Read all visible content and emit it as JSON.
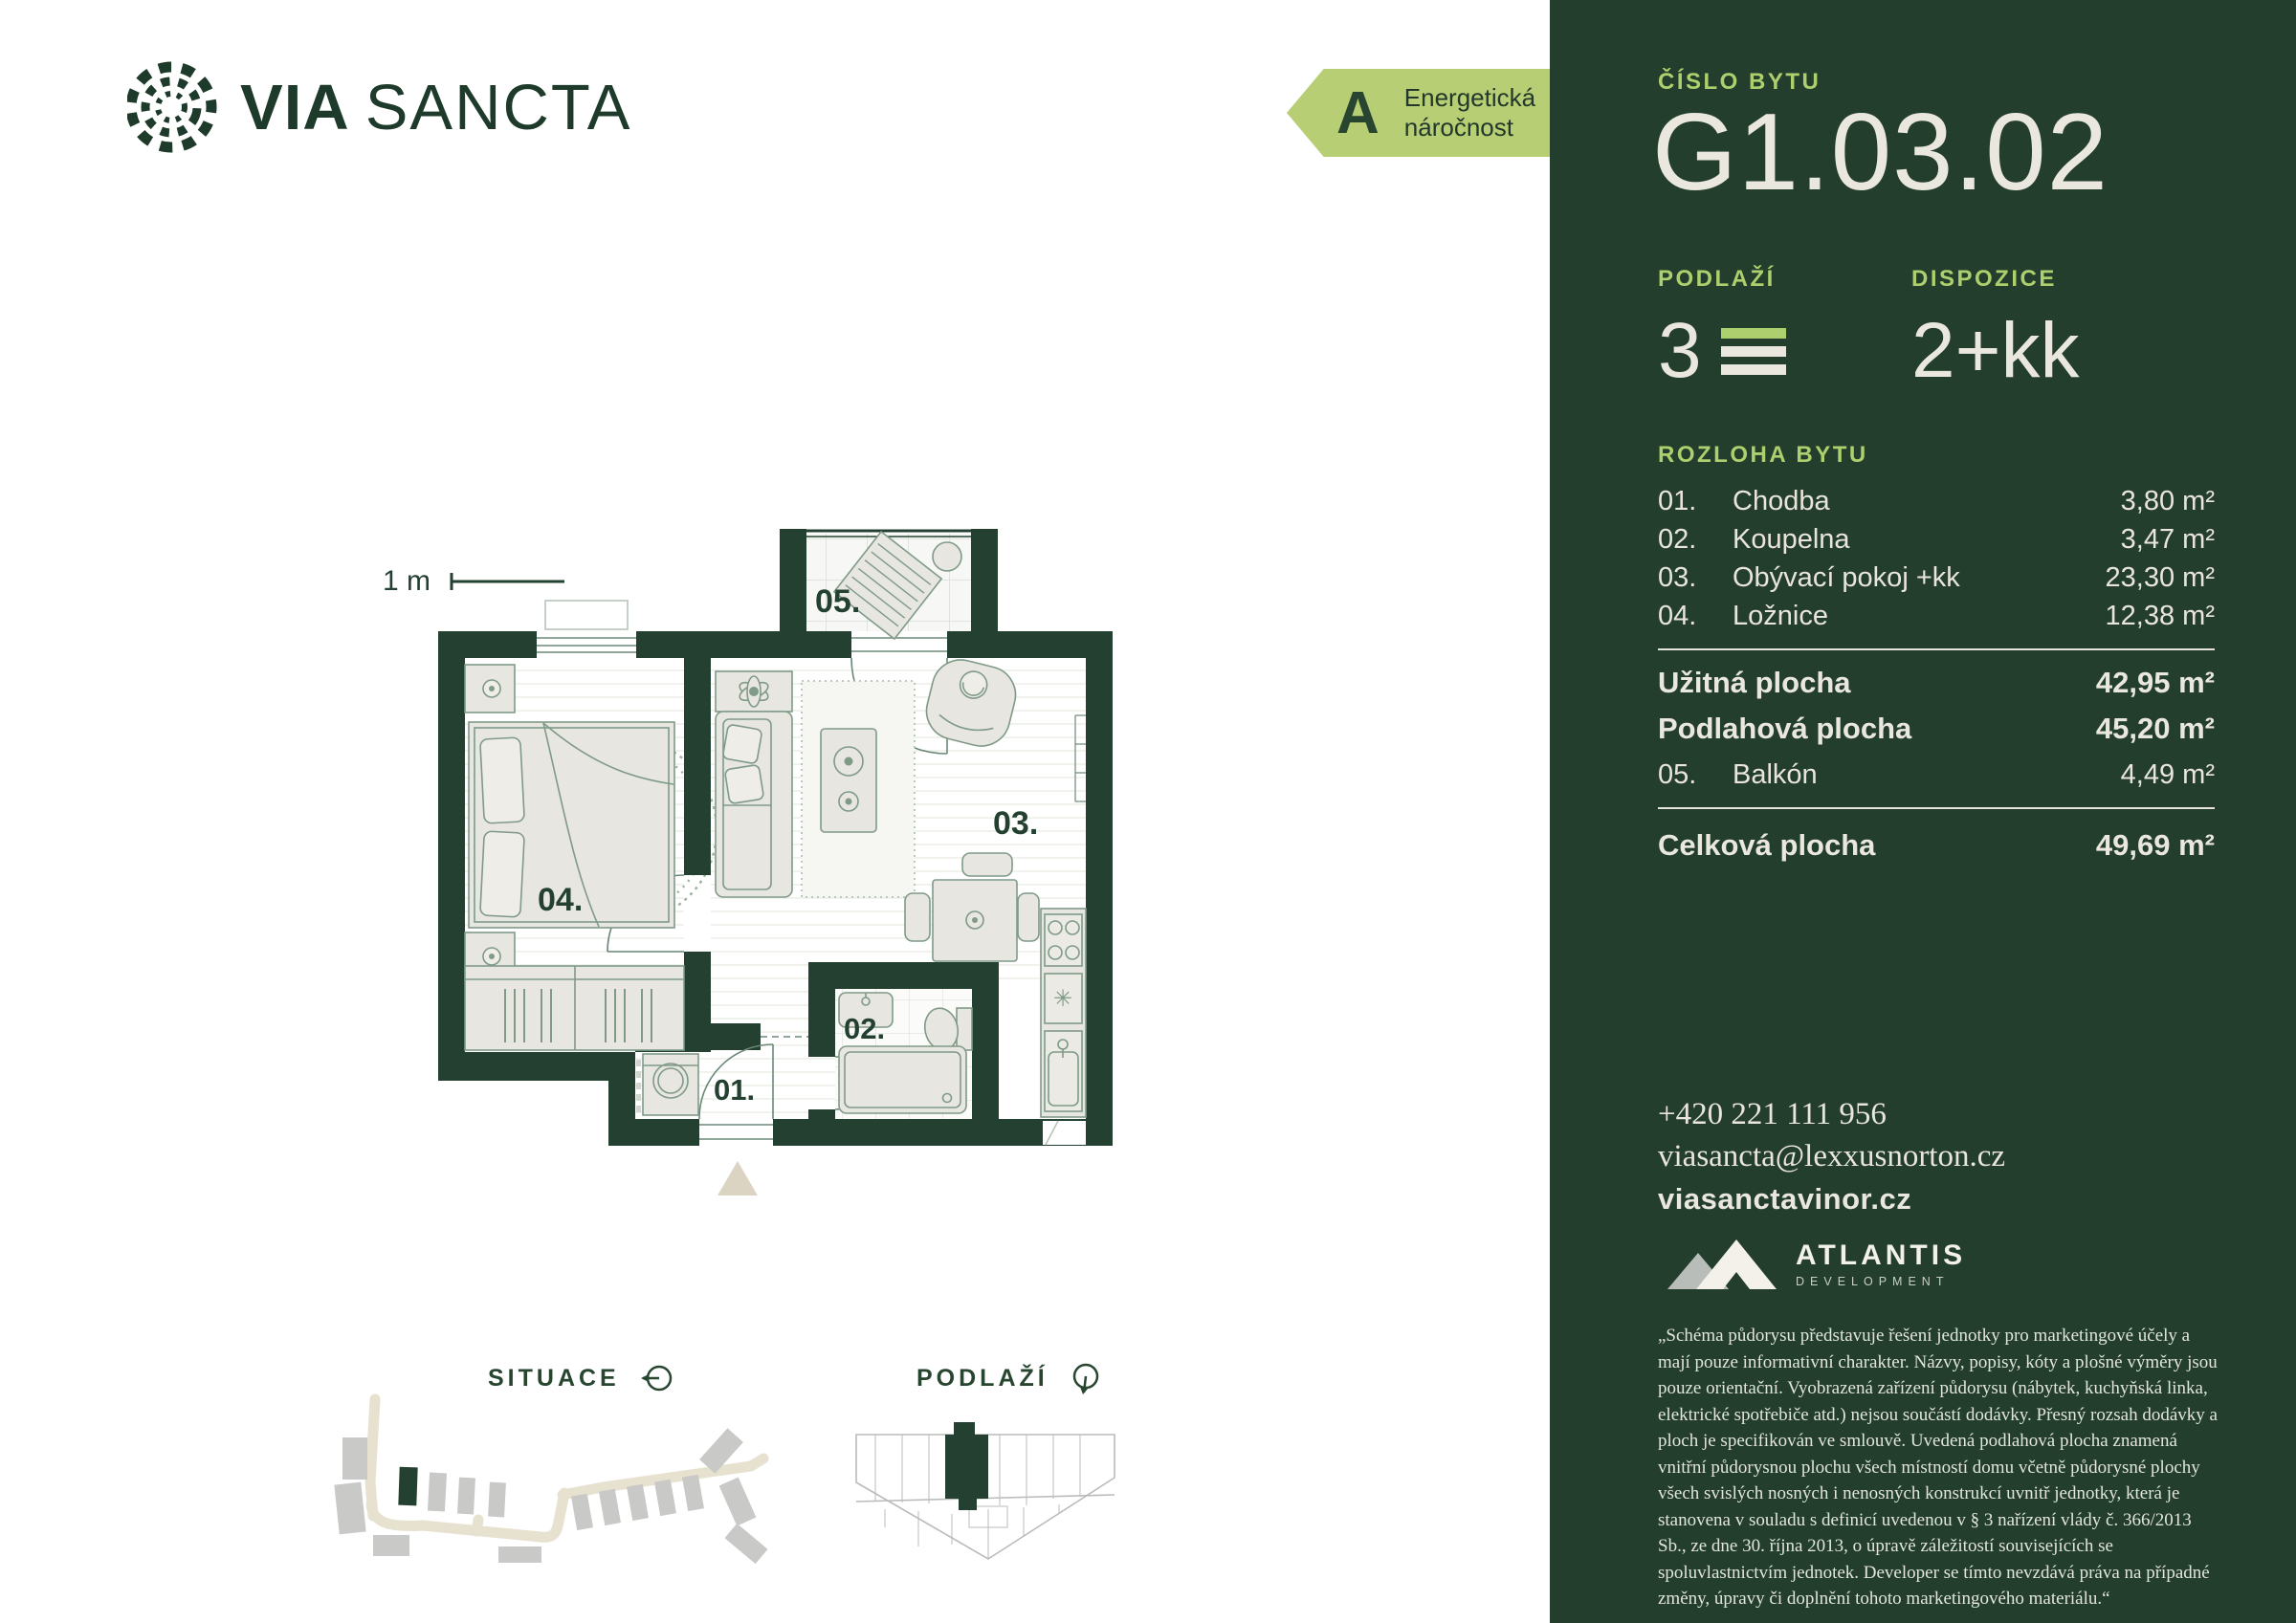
{
  "colors": {
    "dark_green": "#233e2d",
    "wall_green": "#234030",
    "lime": "#aecf6e",
    "badge_green": "#b7ce74",
    "cream": "#eae7df",
    "furniture": "#e7e6e0",
    "furniture_stroke": "#7f9a87",
    "beige": "#dbd4c2",
    "map_gray": "#c9c9c7"
  },
  "brand": {
    "name_bold": "VIA",
    "name_light": "SANCTA"
  },
  "energy": {
    "grade": "A",
    "line1": "Energetická",
    "line2": "náročnost"
  },
  "floorplan": {
    "scale_label": "1 m",
    "labels": {
      "r01": "01.",
      "r02": "02.",
      "r03": "03.",
      "r04": "04.",
      "r05": "05."
    }
  },
  "maps": {
    "situace_title": "SITUACE",
    "podlazi_title": "PODLAŽÍ"
  },
  "panel": {
    "cislo_bytu_label": "ČÍSLO BYTU",
    "unit_number": "G1.03.02",
    "podlazi_label": "PODLAŽÍ",
    "podlazi_value": "3",
    "dispozice_label": "DISPOZICE",
    "dispozice_value": "2+kk",
    "rozloha_label": "ROZLOHA BYTU",
    "rooms": [
      {
        "num": "01.",
        "name": "Chodba",
        "area": "3,80 m²"
      },
      {
        "num": "02.",
        "name": "Koupelna",
        "area": "3,47 m²"
      },
      {
        "num": "03.",
        "name": "Obývací pokoj +kk",
        "area": "23,30 m²"
      },
      {
        "num": "04.",
        "name": "Ložnice",
        "area": "12,38 m²"
      }
    ],
    "uzitna": {
      "label": "Užitná plocha",
      "value": "42,95 m²"
    },
    "podlahova": {
      "label": "Podlahová plocha",
      "value": "45,20 m²"
    },
    "balkon": {
      "num": "05.",
      "name": "Balkón",
      "area": "4,49 m²"
    },
    "celkova": {
      "label": "Celková plocha",
      "value": "49,69 m²"
    },
    "contact": {
      "phone": "+420 221 111 956",
      "email": "viasancta@lexxusnorton.cz",
      "web": "viasanctavinor.cz"
    },
    "developer": {
      "name": "ATLANTIS",
      "sub": "DEVELOPMENT"
    },
    "disclaimer": "„Schéma půdorysu představuje řešení jednotky pro marketingové účely a mají pouze informativní charakter. Názvy, popisy, kóty a plošné výměry jsou pouze orientační. Vyobrazená zařízení půdorysu (nábytek, kuchyňská linka, elektrické spotřebiče atd.) nejsou součástí dodávky. Přesný rozsah dodávky a ploch je specifikován ve smlouvě. Uvedená podlahová plocha znamená vnitřní půdorysnou plochu všech místností domu včetně půdorysné plochy všech svislých nosných i nenosných konstrukcí uvnitř jednotky, která je stanovena v souladu s definicí uvedenou v § 3 nařízení vlády č. 366/2013 Sb., ze dne 30. října 2013, o úpravě záležitostí souvisejících se spoluvlastnictvím jednotek. Developer se tímto nevzdává práva na případné změny, úpravy či doplnění tohoto marketingového materiálu.“"
  }
}
